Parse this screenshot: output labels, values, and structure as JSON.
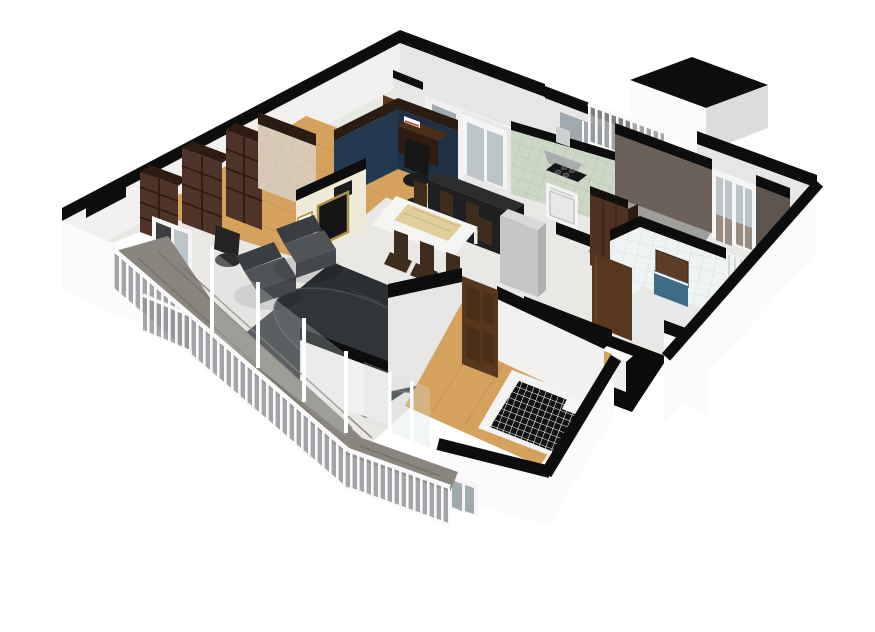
{
  "meta": {
    "view": "isometric-cutaway-3d-floor-plan",
    "background": "#ffffff",
    "width": 875,
    "height": 632
  },
  "scene": {
    "rooms": [
      {
        "id": "hallway"
      },
      {
        "id": "study-library",
        "features": [
          "bookshelves",
          "beige-accent-wall",
          "balcony-doors",
          "desk-chair"
        ]
      },
      {
        "id": "desk-nook",
        "features": [
          "navy-accent-walls",
          "desk",
          "office-chair"
        ]
      },
      {
        "id": "living-room",
        "features": [
          "tv-wall",
          "gold-framed-tv",
          "picture-frame",
          "two-armchairs",
          "dark-rug",
          "oval-rug",
          "glass-balustrade"
        ]
      },
      {
        "id": "dining-area",
        "features": [
          "wood-top-table",
          "seven-dark-chairs"
        ]
      },
      {
        "id": "kitchen",
        "features": [
          "green-tile-wall",
          "range-hood",
          "stove",
          "dark-bar-counter",
          "fridge-column",
          "window"
        ]
      },
      {
        "id": "second-bedroom",
        "features": [
          "taupe-walls",
          "window",
          "radiator",
          "wardrobe"
        ]
      },
      {
        "id": "bathroom",
        "features": [
          "white-tile-walls",
          "mirror",
          "blue-vanity",
          "brown-door"
        ]
      },
      {
        "id": "wc",
        "features": [
          "black-floor",
          "washer"
        ]
      },
      {
        "id": "bedroom",
        "features": [
          "oak-floor",
          "bed-black-grid-blanket",
          "pillows",
          "brown-door",
          "balcony-door"
        ]
      },
      {
        "id": "balcony",
        "features": [
          "weathered-plank-floor",
          "white-picket-railing"
        ]
      },
      {
        "id": "kitchen-balcony",
        "features": [
          "white-picket-railing"
        ]
      }
    ]
  },
  "palette": {
    "wallCap": "#0d0d0d",
    "capBrown": "#2a1c12",
    "wallFace": "#f2f1ef",
    "wallFaceShade": "#e7e6e4",
    "wallFaceDark": "#dcdcdb",
    "exterior": "#fbfbfb",
    "marbleFloor": "#eae8e4",
    "woodFloor": "#d5a25e",
    "woodLine": "#bf8d4b",
    "nookNavy": "#23394f",
    "nookNavyDark": "#1d3044",
    "beigeWall": "#d8cab6",
    "creamWall": "#efe9d8",
    "goldFrame": "#ab8f4b",
    "tvBlack": "#141414",
    "shelfBrown": "#4f3328",
    "shelfBrownDark": "#2e1c12",
    "shelfLine": "#2a1a10",
    "greenTile": "#ccd7c5",
    "greenTileLine": "#b7c5b0",
    "hoodGray": "#a9adad",
    "ductGray": "#cdd0d0",
    "applianceWhite": "#f3f3f3",
    "ovenGray": "#e7e9e9",
    "counterTop": "#2c2d2e",
    "counterFront": "#1e1f20",
    "counterSide": "#141516",
    "fridgeFront": "#c5c7c6",
    "fridgeTop": "#d8dad9",
    "fridgeSide": "#aeb0af",
    "taupeWall": "#6b6158",
    "taupeWallDark": "#5e564e",
    "concreteFloor": "#a09e9a",
    "windowFrame": "#f5f5f5",
    "windowGlass": "#bcc5c9",
    "radiatorWhite": "#f1f2f2",
    "radiatorLine": "#c9cccc",
    "doorBrown": "#57381f",
    "doorBrownDark": "#4a2e18",
    "wardrobeBrown": "#4f3120",
    "tileWall": "#f0f3f3",
    "tileLine": "#d7dcdc",
    "mirrorBrown": "#5d3c28",
    "vanityBlue": "#3e6c87",
    "wcFloor": "#0b0b0c",
    "rugDark": "#2b2e32",
    "rugTexture": "#41454b",
    "ovalRug": "#31353a",
    "ovalRugEdge": "#484d53",
    "armchair": "#3a3d41",
    "armchairSeat": "#505459",
    "armchairFront": "#44484c",
    "diningChair": "#3e2c1d",
    "tableWhite": "#f5f5f3",
    "tableWood": "#e2cd9c",
    "tableWoodLine": "#cdb67f",
    "bedFrame": "#f3f3f3",
    "bedBlack": "#111111",
    "bedGridLine": "#ffffff",
    "balconyWood": "#8a867f",
    "balconyWoodLine": "#746c60",
    "railBg": "#94979a",
    "railWhite": "#fafafa",
    "glassTint": "#d3dee0",
    "doorGlass": "#9fa9ae"
  }
}
